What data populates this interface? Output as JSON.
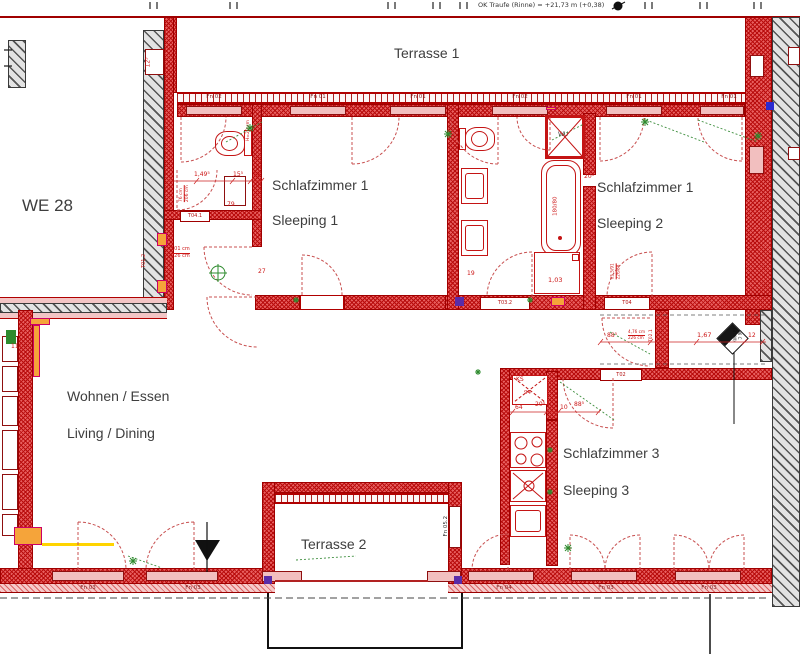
{
  "note": "OK Traufe (Rinne) = +21,73 m (+0,38)",
  "unit_label": "WE 28",
  "rooms": {
    "terrasse1": "Terrasse 1",
    "sleeping1_de": "Schlafzimmer 1",
    "sleeping1_en": "Sleeping 1",
    "sleeping2_de": "Schlafzimmer 1",
    "sleeping2_en": "Sleeping 2",
    "living_de": "Wohnen / Essen",
    "living_en": "Living / Dining",
    "sleeping3_de": "Schlafzimmer 3",
    "sleeping3_en": "Sleeping 3",
    "terrasse2": "Terrasse 2"
  },
  "windows": {
    "top": [
      "Fn 02",
      "Fn 01",
      "Fn 01",
      "Fn 02",
      "Fn 01",
      "Fn 01"
    ],
    "bottom": [
      "Fn 03",
      "Fn 03",
      "Fn 04",
      "Fn 03",
      "Fn 03"
    ],
    "side": "Fn 05.2"
  },
  "doors": {
    "wc": "T04.1",
    "hall": "T01.2",
    "bath": "T03.2",
    "bedroom2": "T04",
    "corridor": "T02",
    "partition": "T02.1"
  },
  "fixtures": {
    "shower": "WU",
    "tub": "180/80",
    "fridge": "KS",
    "cabinet": "1,03"
  },
  "badge": {
    "line1": "06 C",
    "line2": "(BT/W)"
  },
  "dims": {
    "d12_5": "12⁵",
    "d11_8": "11⁸",
    "d1_49_5": "1,49⁵",
    "d15_5": "15⁵",
    "d15": "15",
    "d76": "76 cm",
    "d206": "206 cm",
    "d101": "101 cm",
    "d226": "226 cm",
    "d79": "79",
    "d27": "27",
    "h20_a": "H=20 cm",
    "h20_b": "H=20 cm",
    "d19": "19",
    "d20_5_bath": "20⁵",
    "d65_5": "65,5/91",
    "d226_88": "226/88",
    "d94": "94",
    "d64": "64",
    "d20_5_kitchen": "20⁵",
    "d10": "10",
    "d88_5_kitchen": "88⁵",
    "d88_5_corridor": "88⁵",
    "d4_76": "4,76 cm",
    "d226_corridor": "226 cm",
    "d1_67": "1,67",
    "d12": "12",
    "d1_03": "1,03"
  }
}
